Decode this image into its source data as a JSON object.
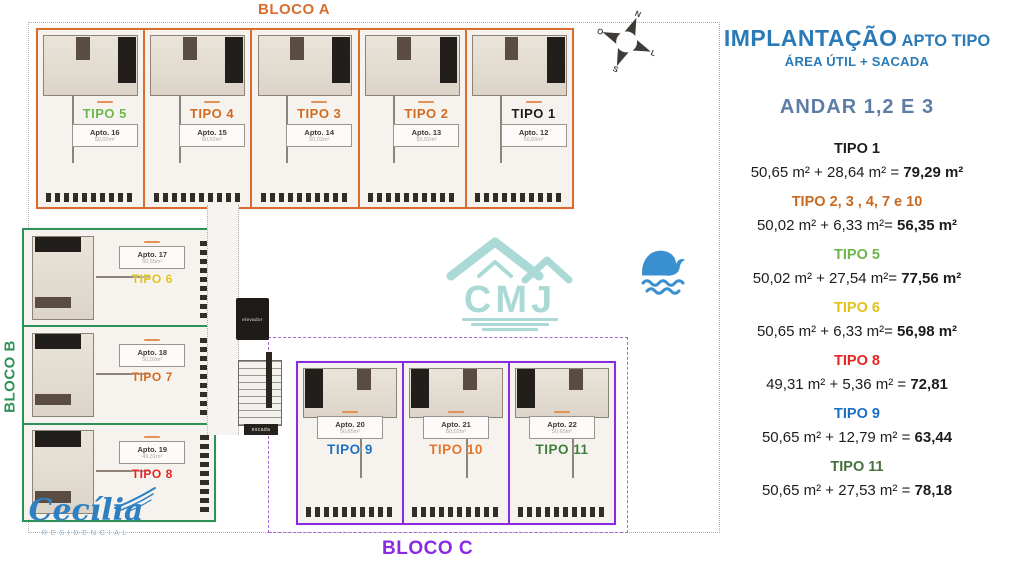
{
  "header": {
    "title_main": "IMPLANTAÇÃO",
    "title_suffix": " APTO TIPO",
    "subtitle": "ÁREA ÚTIL + SACADA",
    "floors": "ANDAR 1,2 E 3",
    "title_color": "#2a7ab8",
    "floors_color": "#5d7da5"
  },
  "legend": {
    "items": [
      {
        "tipo": "TIPO 1",
        "color": "#1c1c1c",
        "expr": "50,65 m² + 28,64 m²  =",
        "result": "79,29 m²"
      },
      {
        "tipo": "TIPO 2, 3 , 4, 7 e 10",
        "color": "#c9681f",
        "expr": "50,02 m² + 6,33 m²=",
        "result": "56,35 m²"
      },
      {
        "tipo": "TIPO 5",
        "color": "#6cb64c",
        "expr": "50,02 m² + 27,54 m²=",
        "result": "77,56 m²"
      },
      {
        "tipo": "TIPO 6",
        "color": "#e2c118",
        "expr": "50,65 m² + 6,33 m²=",
        "result": "56,98 m²"
      },
      {
        "tipo": "TIPO 8",
        "color": "#e52320",
        "expr": "49,31 m² + 5,36 m² =",
        "result": "72,81"
      },
      {
        "tipo": "TIPO 9",
        "color": "#1f6fc0",
        "expr": "50,65 m² + 12,79 m² =",
        "result": "63,44"
      },
      {
        "tipo": "TIPO 11",
        "color": "#47703c",
        "expr": "50,65 m² + 27,53 m² =",
        "result": "78,18"
      }
    ]
  },
  "blocks": [
    {
      "id": "a",
      "name": "BLOCO A",
      "color": "#d96c2e",
      "units": [
        {
          "tipo": "TIPO 5",
          "color": "#6cb64c",
          "apto": "Apto. 16",
          "area": "50,02m²"
        },
        {
          "tipo": "TIPO 4",
          "color": "#d2691f",
          "apto": "Apto. 15",
          "area": "50,02m²"
        },
        {
          "tipo": "TIPO 3",
          "color": "#d2691f",
          "apto": "Apto. 14",
          "area": "50,02m²"
        },
        {
          "tipo": "TIPO 2",
          "color": "#d2691f",
          "apto": "Apto. 13",
          "area": "50,02m²"
        },
        {
          "tipo": "TIPO 1",
          "color": "#1c1c1c",
          "apto": "Apto. 12",
          "area": "50,65m²"
        }
      ]
    },
    {
      "id": "b",
      "name": "BLOCO B",
      "color": "#2e9258",
      "units": [
        {
          "tipo": "TIPO 6",
          "color": "#e2c118",
          "apto": "Apto. 17",
          "area": "50,65m²"
        },
        {
          "tipo": "TIPO 7",
          "color": "#d2691f",
          "apto": "Apto. 18",
          "area": "50,02m²"
        },
        {
          "tipo": "TIPO 8",
          "color": "#e52320",
          "apto": "Apto. 19",
          "area": "49,31m²"
        }
      ]
    },
    {
      "id": "c",
      "name": "BLOCO C",
      "color": "#8a2be2",
      "units": [
        {
          "tipo": "TIPO 9",
          "color": "#1f6fc0",
          "apto": "Apto. 20",
          "area": "50,65m²"
        },
        {
          "tipo": "TIPO 10",
          "color": "#e8732a",
          "apto": "Apto. 21",
          "area": "50,02m²"
        },
        {
          "tipo": "TIPO 11",
          "color": "#3f7d3a",
          "apto": "Apto. 22",
          "area": "50,65m²"
        }
      ]
    }
  ],
  "plan": {
    "elevator": "elevador",
    "stairs": "escada"
  },
  "compass": {
    "n": "N",
    "e": "L",
    "s": "S",
    "w": "O"
  },
  "logos": {
    "watermark": "CMJ",
    "brand": "Cecília",
    "brand_sub": "RESIDENCIAL"
  }
}
